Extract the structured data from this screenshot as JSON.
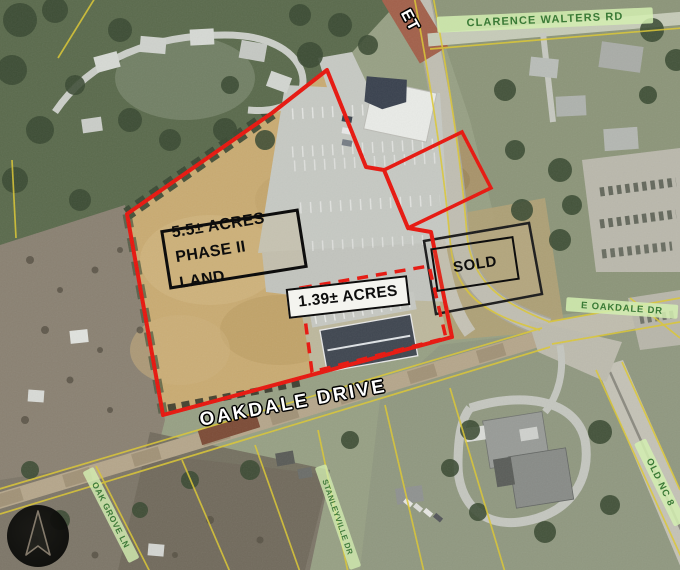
{
  "parcels": {
    "phase2": {
      "line1": "5.5± ACRES",
      "line2": "PHASE II LAND"
    },
    "pad": {
      "label": "1.39± ACRES"
    },
    "sold": {
      "label": "SOLD"
    }
  },
  "streets": {
    "clarence_walters": "CLARENCE WALTERS RD",
    "partial_top": "ET",
    "oakdale_drive": "OAKDALE DRIVE",
    "e_oakdale": "E OAKDALE DR",
    "old_nc8": "OLD NC 8",
    "oak_grove": "OAK GROVE LN",
    "stanleyville": "STANLEYVILLE DR"
  },
  "colors": {
    "boundary_red": "#e8150d",
    "parcel_line_yellow": "#ddc832",
    "street_label_green": "#3a7a36",
    "annotation_black": "#0d0d0d",
    "field_tan": "#c9ab72"
  }
}
